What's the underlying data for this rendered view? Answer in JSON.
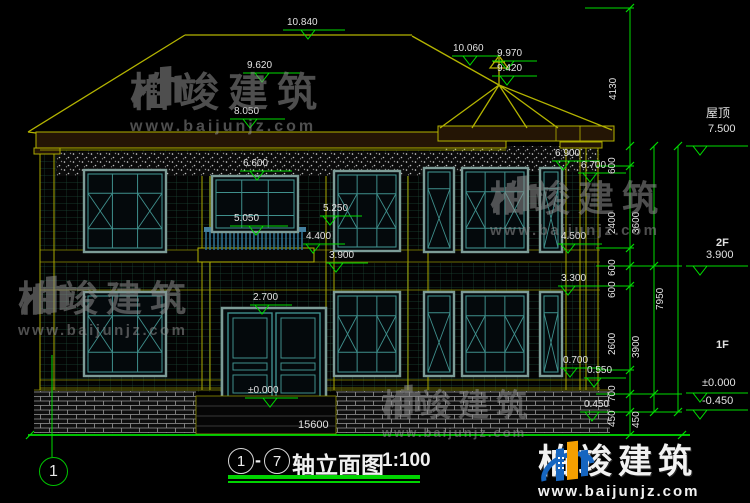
{
  "drawing": {
    "title": {
      "axis_start": "1",
      "axis_end": "7",
      "dash": "-",
      "name": "轴立面图",
      "scale": "1:100"
    },
    "axis_bubble": "1",
    "watermark": {
      "brand": "柏竣建筑",
      "url": "www.baijunjz.com"
    },
    "right_levels": {
      "roof_label": "屋顶",
      "roof": "7.500",
      "f2_label": "2F",
      "f2": "3.900",
      "f1_label": "1F",
      "zero": "±0.000",
      "minus": "-0.450"
    },
    "elevation_marks": {
      "v10840": "10.840",
      "v9620": "9.620",
      "v8050": "8.050",
      "v10060": "10.060",
      "v9970": "9.970",
      "v9420": "9.420",
      "v6600": "6.600",
      "v6900": "6.900",
      "v6700": "6.700",
      "v5250": "5.250",
      "v5050": "5.050",
      "v4400": "4.400",
      "v3900": "3.900",
      "v4500": "4.500",
      "v3300": "3.300",
      "v2700": "2.700",
      "v0700": "0.700",
      "v0550": "0.550",
      "v0450": "0.450",
      "zero": "±0.000"
    },
    "dims": {
      "total_width": "15600",
      "roof_height": "4130",
      "chain1": [
        "600",
        "2400",
        "600",
        "600",
        "2600",
        "700",
        "450"
      ],
      "chain2": [
        "3600",
        "3900",
        "450"
      ],
      "chain3": [
        "7950"
      ]
    },
    "colors": {
      "dimension_green": "#00dc00",
      "outline_yellow": "#b4b400",
      "window_teal": "#3f8f8c",
      "logo_blue": "#1565c0",
      "logo_orange": "#f59f00"
    }
  }
}
